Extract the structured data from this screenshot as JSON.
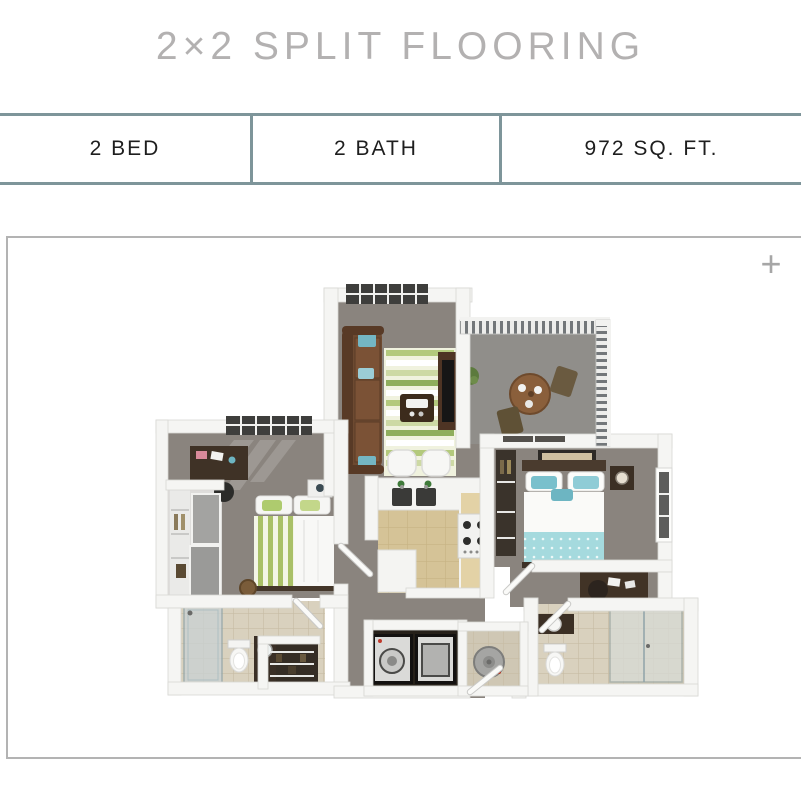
{
  "header": {
    "title": "2×2 SPLIT FLOORING"
  },
  "stats": {
    "cells": [
      {
        "label": "2 BED"
      },
      {
        "label": "2 BATH"
      },
      {
        "label": "972 SQ. FT."
      }
    ],
    "border_color": "#7e959a"
  },
  "floorplan": {
    "expand_icon": "+",
    "frame_border_color": "#b3b3b3",
    "colors": {
      "carpet": "#8a847e",
      "balcony_floor": "#908e8a",
      "kitchen_floor": "#d5c397",
      "bathroom_tile": "#d9d1be",
      "wall_white": "#f5f5f3",
      "window_frame": "#3e3e3c",
      "sofa_brown": "#6d4a31",
      "wood_dark": "#413326",
      "accent_teal": "#79c0cc",
      "bed_blanket_teal": "#a5dade",
      "accent_green": "#a9c067",
      "appliance_dark": "#131110"
    }
  }
}
